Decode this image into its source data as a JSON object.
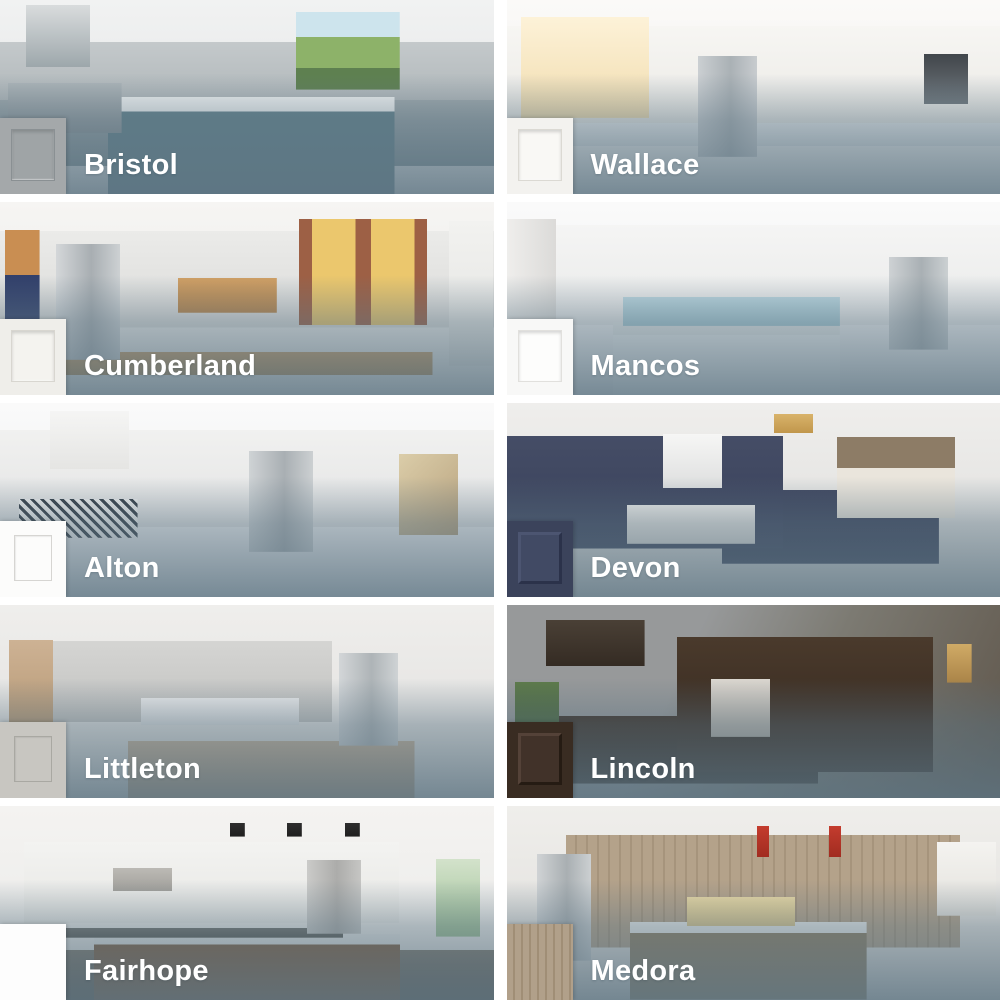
{
  "grid": {
    "columns": 2,
    "rows": 5
  },
  "label_color": "#ffffff",
  "overlay_color": "#5b7382",
  "tiles": [
    {
      "name": "Bristol",
      "door_style": "shaker",
      "scene": "gray kitchen with stainless range, white marble island, garden window",
      "swatch": {
        "base": "#a4a8aa",
        "panel": "#9fa4a6",
        "line": "#8a9093"
      }
    },
    {
      "name": "Wallace",
      "door_style": "shaker",
      "scene": "bright white kitchen with sunny windows, brass faucet, stainless fridge and wall oven",
      "swatch": {
        "base": "#f3f2ef",
        "panel": "#f9f8f5",
        "line": "#dbd9d3"
      }
    },
    {
      "name": "Cumberland",
      "door_style": "shaker",
      "scene": "white kitchen with wood-top island, brick wall, autumn windows, wooden bar stools",
      "swatch": {
        "base": "#efeeea",
        "panel": "#f4f3ef",
        "line": "#d8d6d0"
      }
    },
    {
      "name": "Mancos",
      "door_style": "shaker",
      "scene": "white kitchen with light-blue tile backsplash, blue glass pendants, marble island",
      "swatch": {
        "base": "#f8f8f7",
        "panel": "#fdfdfc",
        "line": "#e1e0dd"
      }
    },
    {
      "name": "Alton",
      "door_style": "recessed-square",
      "scene": "white kitchen with black-and-white patterned backsplash, copper pendants, wood stools",
      "swatch": {
        "base": "#fcfcfb",
        "line": "#d6d5d2"
      }
    },
    {
      "name": "Devon",
      "door_style": "raised-panel",
      "scene": "navy blue cabinets, white hood and subway tile, bay window seat with woven blinds",
      "swatch": {
        "base": "#3b435b",
        "panel": "#414a64",
        "hi": "#4c5571",
        "lo": "#2b324a"
      }
    },
    {
      "name": "Littleton",
      "door_style": "recessed-square",
      "scene": "light gray cabinets, glass pendants, wood farm table with plaid pillows",
      "swatch": {
        "base": "#c8c6c1",
        "line": "#a9a8a2"
      }
    },
    {
      "name": "Lincoln",
      "door_style": "raised-panel",
      "scene": "dark espresso home office with desk chair, gallery frames, floor lamp, leather chair",
      "swatch": {
        "base": "#392c22",
        "panel": "#413229",
        "hi": "#544238",
        "lo": "#251b13"
      }
    },
    {
      "name": "Fairhope",
      "door_style": "slab",
      "scene": "modern flat-front white kitchen, black cone pendants, walnut island with round stools",
      "swatch": {
        "base": "#fdfdfd"
      }
    },
    {
      "name": "Medora",
      "door_style": "woodgrain-slab",
      "scene": "driftwood woodgrain cabinets, cream tile backsplash, red pendants, cream bar stools",
      "swatch": {
        "base": "#b1a08a",
        "grain": "#a08e76"
      }
    }
  ]
}
